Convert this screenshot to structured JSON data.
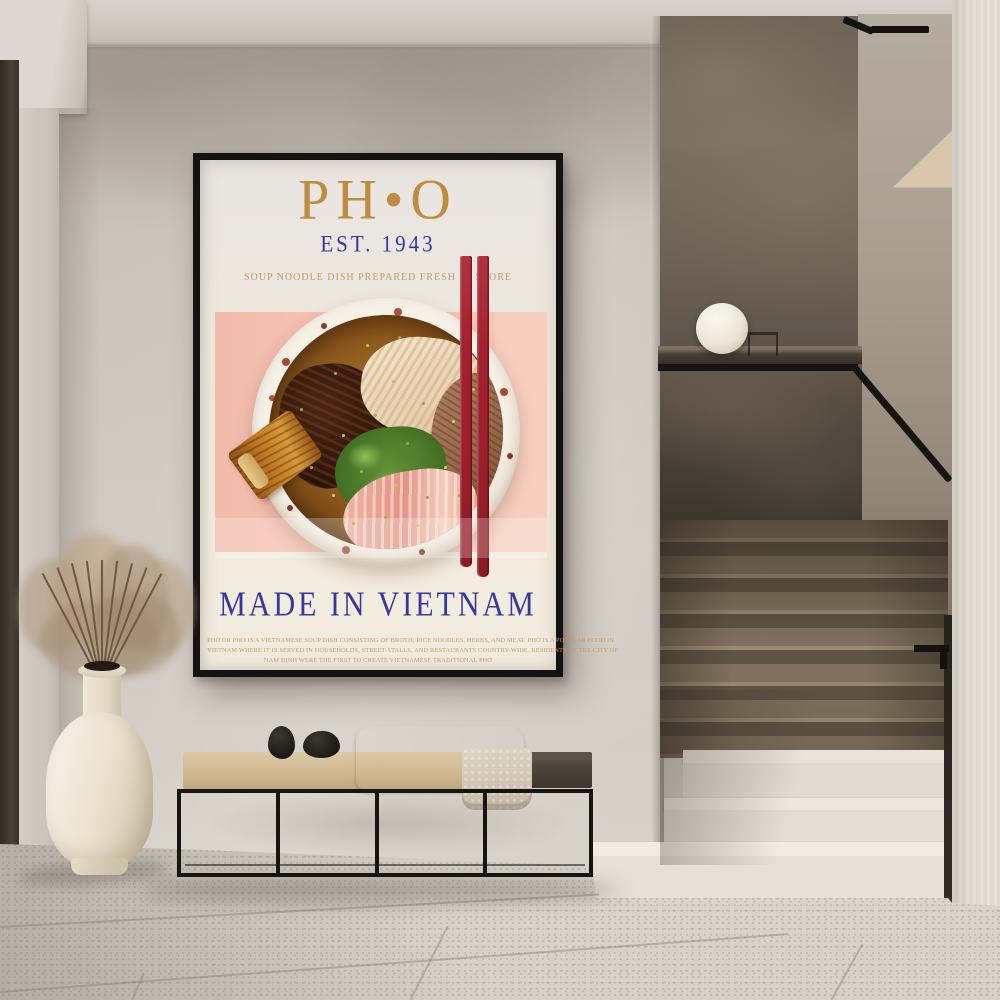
{
  "poster": {
    "title": "PH•O",
    "established": "EST. 1943",
    "subtitle": "SOUP NOODLE DISH PREPARED FRESH IN STORE",
    "headline": "MADE IN VIETNAM",
    "description_lines": [
      "PHỞ OR PHO IS A VIETNAMESE SOUP DISH CONSISTING OF BROTH, RICE NOODLES, HERBS, AND MEAT. PHỞ IS A POPULAR FOOD IN",
      "VIETNAM WHERE IT IS SERVED IN HOUSEHOLDS, STREET-STALLS, AND RESTAURANTS COUNTRY-WIDE. RESIDENTS OF THE CITY OF",
      "NAM ĐỊNH WERE THE FIRST TO CREATE VIETNAMESE TRADITIONAL PHỞ"
    ],
    "colors": {
      "title_gold": "#bf8b3f",
      "accent_blue": "#3a36a0",
      "text_tan": "#c19a68",
      "pink_block": "#f3c1b1",
      "chopstick_red": "#a32231",
      "paper_cream": "#f0eade",
      "frame_black": "#15130f"
    }
  }
}
